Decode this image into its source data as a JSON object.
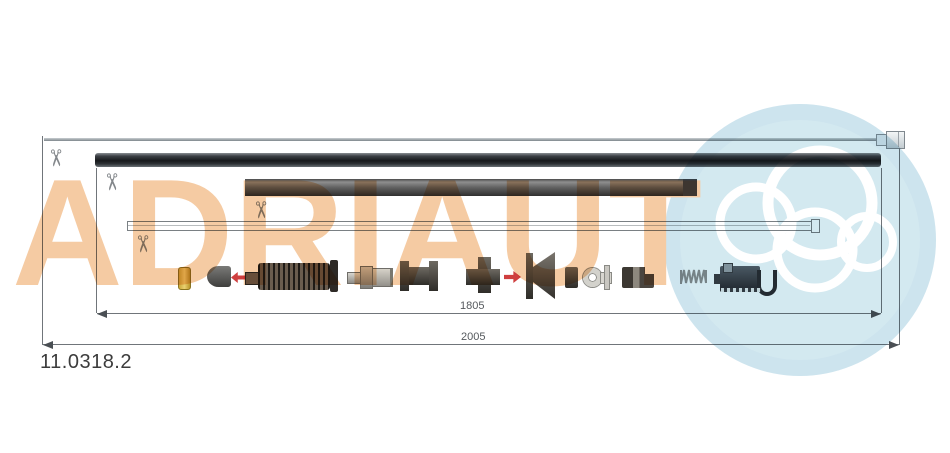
{
  "brand": {
    "watermark_text": "ADRIAUT",
    "letters_color": "#f5cba3",
    "circle_color": "#cde4ee",
    "rings_color": "#ffffff"
  },
  "part": {
    "number": "11.0318.2"
  },
  "dimensions": {
    "inner_length": "1805",
    "outer_length": "2005"
  },
  "icons": {
    "scissors_glyph": "✂",
    "red_arrow_left": "left-arrow",
    "red_arrow_right": "right-arrow"
  },
  "cables": {
    "inner_wire": "thin steel inner wire with end nipple",
    "outer_sheath": "thick black outer sheath",
    "conduit_sleeve": "short protective sleeve",
    "inner_rod": "thin outlined inner rod with end cap"
  },
  "components": [
    "brass-ferrule",
    "end-cone",
    "bellows-boot",
    "pin-fitting",
    "spool-fitting",
    "cross-fitting",
    "funnel-fitting",
    "spacer-block",
    "eyelet-fitting",
    "cylinder-fitting",
    "coil-spring",
    "mounting-bracket"
  ],
  "status_colors": {
    "cut_mark": "#83878b",
    "dimension": "#55595d",
    "accent_red": "#cf3f3f"
  }
}
